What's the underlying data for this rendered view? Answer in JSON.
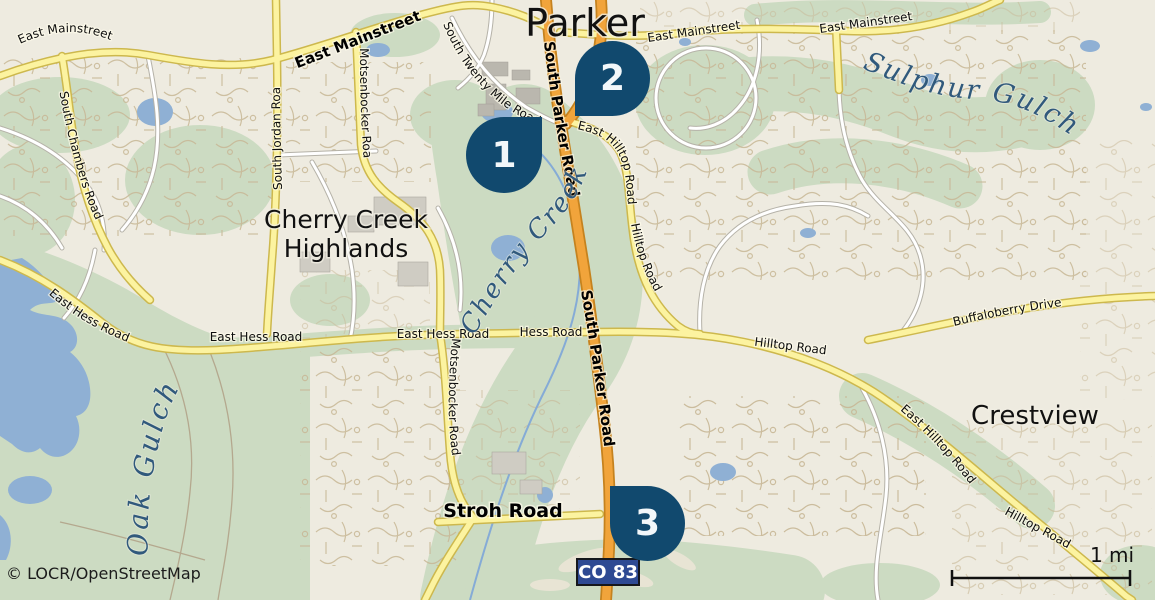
{
  "map": {
    "attribution": "© LOCR/OpenStreetMap",
    "scale_label": "1 mi",
    "route_badge": "CO 83",
    "city_label": "Parker",
    "place_labels": {
      "cherry_creek_highlands_1": "Cherry Creek",
      "cherry_creek_highlands_2": "Highlands",
      "crestview": "Crestview"
    },
    "water_labels": {
      "sulphur_gulch": "Sulphur Gulch",
      "cherry_creek": "Cherry Creek",
      "oak_gulch": "Oak Gulch"
    },
    "road_labels": {
      "mainstreet_w": "East Mainstreet",
      "mainstreet_bold": "East Mainstreet",
      "mainstreet_c": "East Mainstreet",
      "mainstreet_e": "East Mainstreet",
      "s_twenty_mile": "South Twenty Mile Road",
      "s_parker_upper": "South Parker Road",
      "s_parker_lower": "South Parker Road",
      "e_hilltop_upper": "East Hilltop Road",
      "hilltop_upper": "Hilltop Road",
      "motsenbocker_n": "Motsenbocker Road",
      "motsenbocker_s": "Motsenbocker Road",
      "s_jordan": "South Jordan Road",
      "s_chambers": "South Chambers Road",
      "hess_diag": "East Hess Road",
      "hess_1": "East Hess Road",
      "hess_2": "East Hess Road",
      "hess_3": "Hess Road",
      "hilltop_mid": "Hilltop Road",
      "buffaloberry": "Buffaloberry Drive",
      "e_hilltop_se": "East Hilltop Road",
      "hilltop_se": "Hilltop Road",
      "stroh": "Stroh Road"
    },
    "markers": [
      {
        "number": "1"
      },
      {
        "number": "2"
      },
      {
        "number": "3"
      }
    ],
    "colors": {
      "marker": "#11496e",
      "marker_text": "#f2f7fa",
      "badge_bg": "#2e4a93",
      "badge_border": "#15171c",
      "badge_text": "#ffffff",
      "road_primary": "#f1a43b",
      "road_primary_casing": "#c5821e",
      "road_secondary": "#fcf3a0",
      "road_secondary_casing": "#cdb84d",
      "water": "#8fb0d4",
      "greenspace": "#ccdbc2",
      "label_water": "#30597c"
    }
  }
}
